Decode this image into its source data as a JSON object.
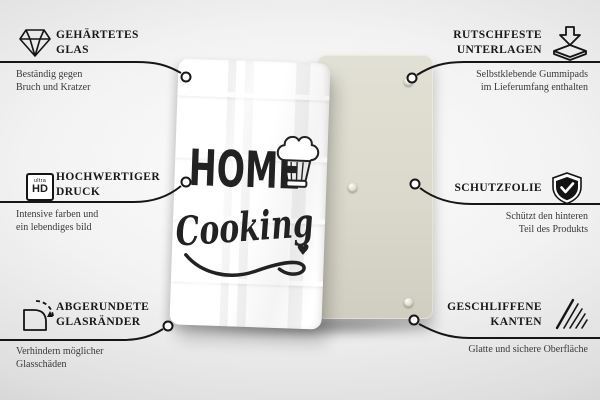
{
  "product": {
    "text_top": "HOME",
    "text_bottom": "Cooking",
    "heart": "♥"
  },
  "callouts": {
    "left": [
      {
        "icon": "diamond-icon",
        "title_lines": [
          "GEHÄRTETES",
          "GLAS"
        ],
        "description_lines": [
          "Beständig gegen",
          "Bruch und Kratzer"
        ]
      },
      {
        "icon": "ultra-hd-icon",
        "icon_labels": [
          "ultra",
          "HD"
        ],
        "title_lines": [
          "HOCHWERTIGER",
          "DRUCK"
        ],
        "description_lines": [
          "Intensive farben und",
          "ein lebendiges bild"
        ]
      },
      {
        "icon": "rounded-corner-icon",
        "title_lines": [
          "ABGERUNDETE",
          "GLASRÄNDER"
        ],
        "description_lines": [
          "Verhindern möglicher",
          "Glasschäden"
        ]
      }
    ],
    "right": [
      {
        "icon": "non-slip-pads-icon",
        "title_lines": [
          "RUTSCHFESTE",
          "UNTERLAGEN"
        ],
        "description_lines": [
          "Selbstklebende Gummipads",
          "im Lieferumfang enthalten"
        ]
      },
      {
        "icon": "shield-check-icon",
        "title_lines": [
          "SCHUTZFOLIE"
        ],
        "description_lines": [
          "Schützt den hinteren",
          "Teil des Produkts"
        ]
      },
      {
        "icon": "polished-edges-icon",
        "title_lines": [
          "GESCHLIFFENE",
          "KANTEN"
        ],
        "description_lines": [
          "Glatte und sichere Oberfläche"
        ]
      }
    ]
  },
  "colors": {
    "line": "#161616",
    "title_text": "#181818",
    "body_text": "#3a3a3a",
    "front_board": "#ffffff",
    "back_board": "#dbdacc",
    "design_ink": "#222222",
    "backdrop": "#ededed"
  }
}
